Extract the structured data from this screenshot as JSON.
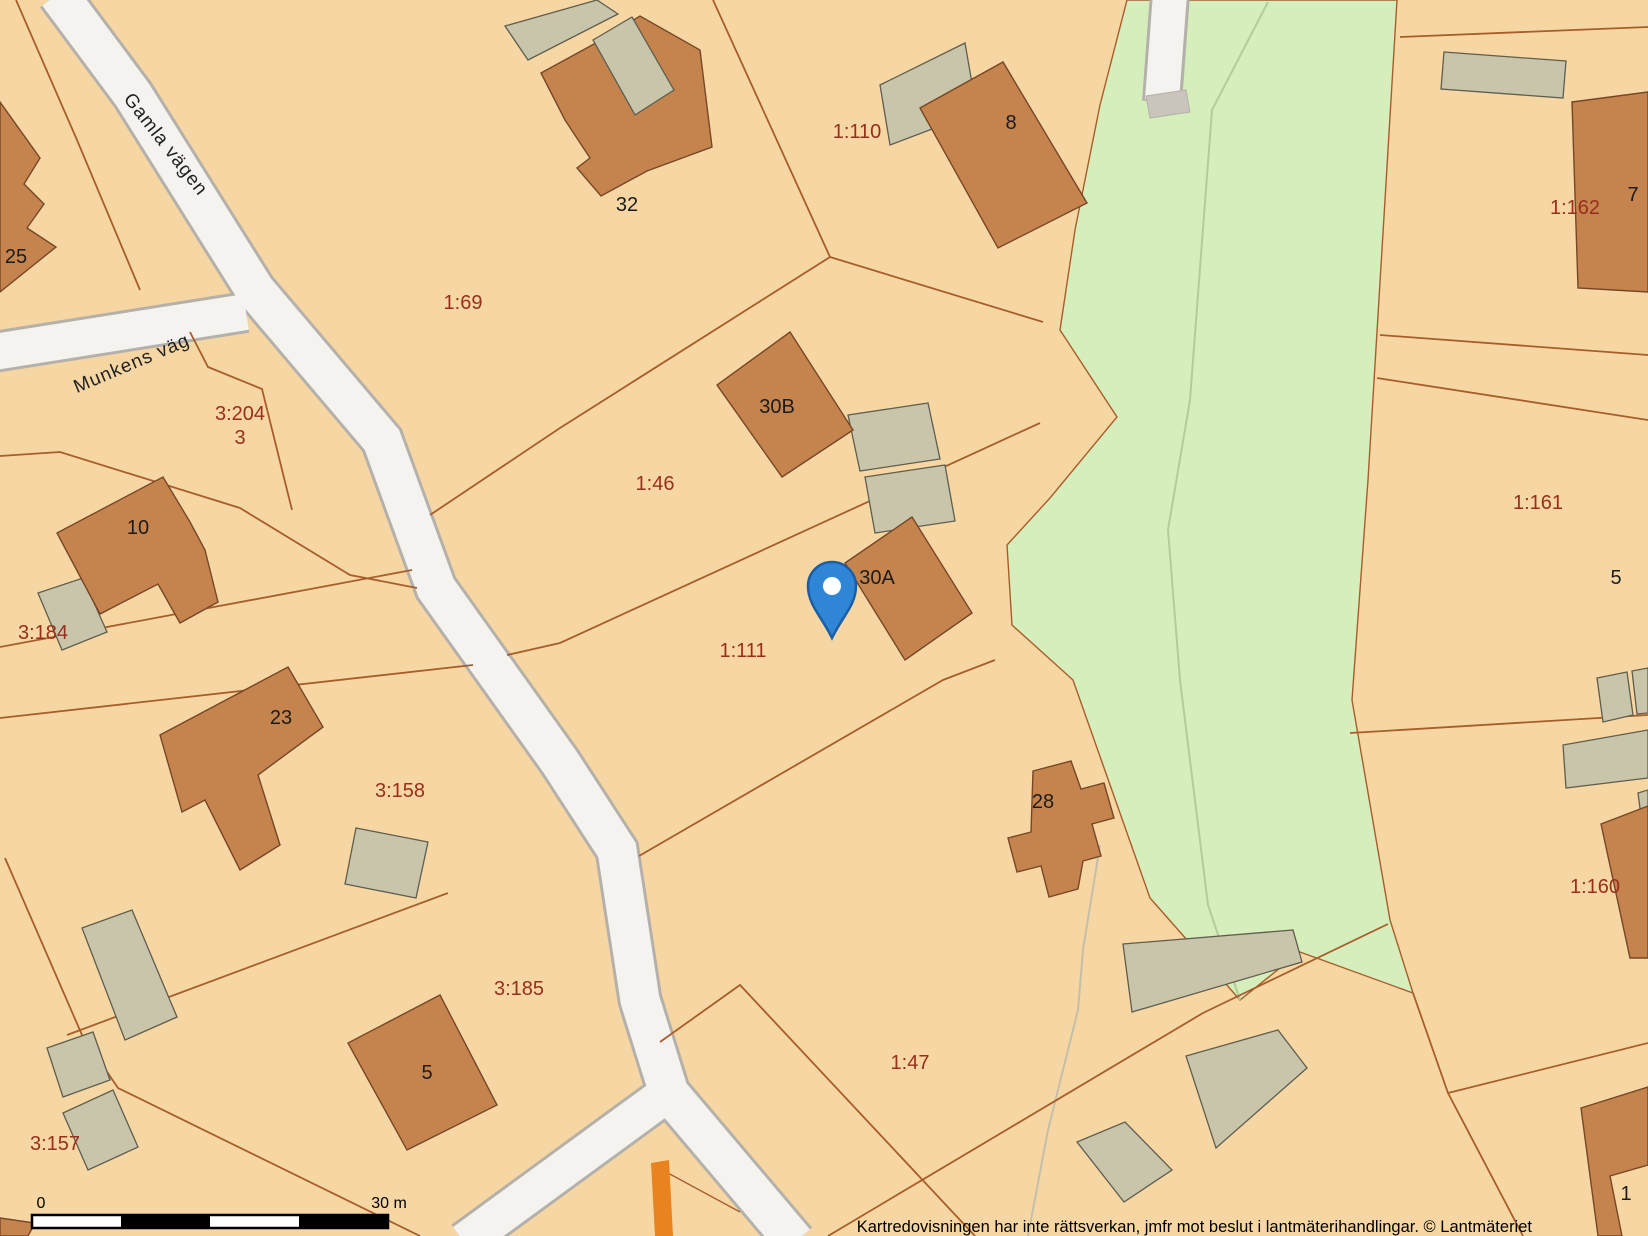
{
  "map": {
    "title": "Cadastral map",
    "colors": {
      "background": "#f6d7a3",
      "green_area": "#d5eebc",
      "road_fill": "#f4f3f0",
      "road_border": "#b5b1aa",
      "parcel_line": "#a85d2b",
      "building_fill": "#c5834e",
      "building_border": "#774726",
      "shed_fill": "#c8c5aa",
      "shed_border": "#605d4f",
      "parcel_label_color": "#992e1d",
      "house_label_color": "#1c1c1c",
      "pin_fill": "#2f86d6",
      "pin_border": "#1b5ea5",
      "orange_marking": "#e8831f"
    },
    "street_labels": [
      {
        "name": "Gamla vägen",
        "x": 161,
        "y": 148,
        "angle": 52
      },
      {
        "name": "Munkens väg",
        "x": 134,
        "y": 369,
        "angle": -23
      }
    ],
    "parcel_labels": [
      {
        "id": "1:69",
        "x": 463,
        "y": 309
      },
      {
        "id": "3:204",
        "x": 240,
        "y": 420
      },
      {
        "id": "3",
        "x": 240,
        "y": 444
      },
      {
        "id": "1:110",
        "x": 857,
        "y": 138
      },
      {
        "id": "1:162",
        "x": 1575,
        "y": 214
      },
      {
        "id": "1:46",
        "x": 655,
        "y": 490
      },
      {
        "id": "1:111",
        "x": 743,
        "y": 657
      },
      {
        "id": "3:184",
        "x": 43,
        "y": 639
      },
      {
        "id": "3:158",
        "x": 400,
        "y": 797
      },
      {
        "id": "1:161",
        "x": 1538,
        "y": 509
      },
      {
        "id": "3:157",
        "x": 55,
        "y": 1150
      },
      {
        "id": "3:185",
        "x": 519,
        "y": 995
      },
      {
        "id": "1:47",
        "x": 910,
        "y": 1069
      },
      {
        "id": "1:160",
        "x": 1595,
        "y": 893
      }
    ],
    "house_numbers": [
      {
        "no": "25",
        "x": 16,
        "y": 263
      },
      {
        "no": "32",
        "x": 627,
        "y": 211
      },
      {
        "no": "8",
        "x": 1011,
        "y": 129
      },
      {
        "no": "7",
        "x": 1633,
        "y": 201
      },
      {
        "no": "30B",
        "x": 777,
        "y": 413
      },
      {
        "no": "30A",
        "x": 877,
        "y": 584
      },
      {
        "no": "10",
        "x": 138,
        "y": 534
      },
      {
        "no": "23",
        "x": 281,
        "y": 724
      },
      {
        "no": "5",
        "x": 427,
        "y": 1079
      },
      {
        "no": "28",
        "x": 1043,
        "y": 808
      },
      {
        "no": "5",
        "x": 1616,
        "y": 584
      },
      {
        "no": "1",
        "x": 1626,
        "y": 1200
      }
    ],
    "pin": {
      "x": 832,
      "y": 588,
      "points_to": "30A"
    },
    "scale_bar": {
      "start_label": "0",
      "end_label": "30 m"
    },
    "footer": {
      "disclaimer": "Kartredovisningen har inte rättsverkan, jmfr mot beslut i lantmäterihandlingar. © Lantmäteriet"
    }
  }
}
